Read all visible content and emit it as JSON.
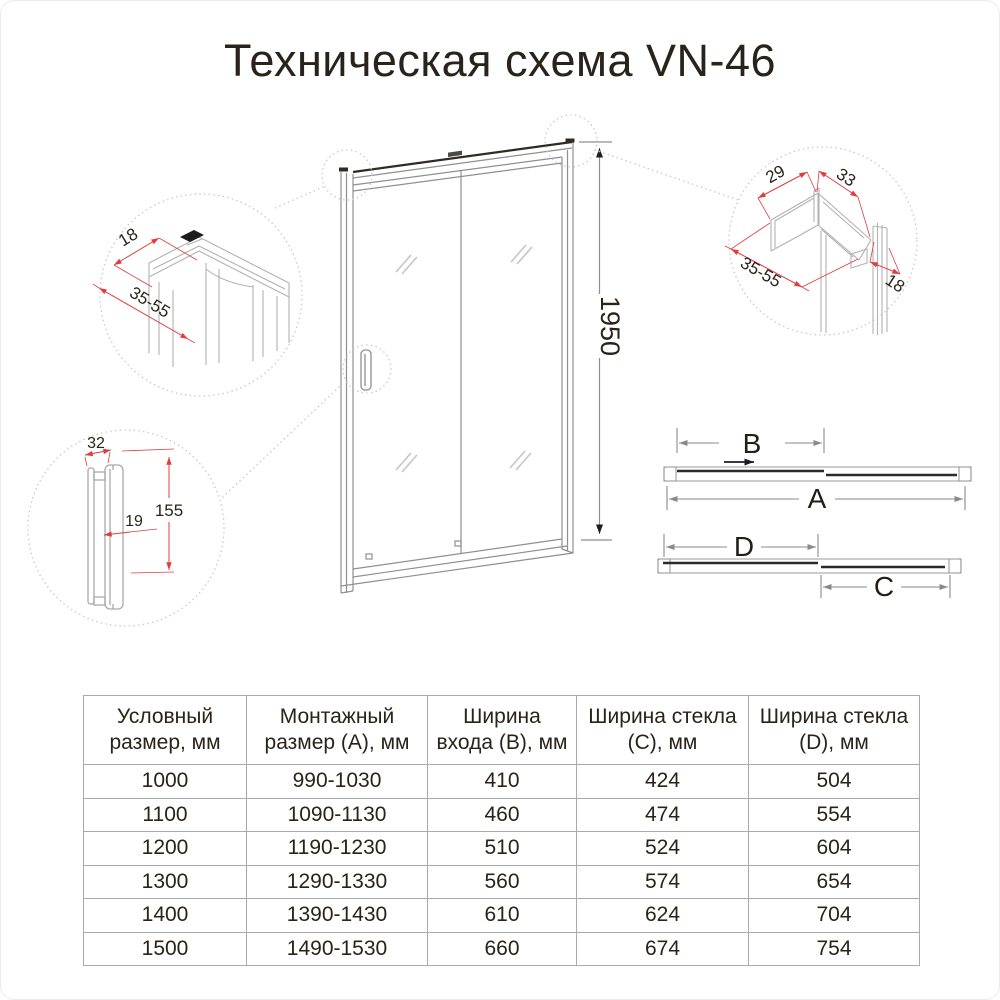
{
  "title": "Техническая схема VN-46",
  "diagram": {
    "door_height_mm": "1950",
    "top_left_detail": {
      "profile_depth": "18",
      "adjustment_range": "35-55"
    },
    "top_right_detail": {
      "inner_width": "29",
      "outer_width": "33",
      "adjustment_range": "35-55",
      "profile_depth": "18"
    },
    "handle_detail": {
      "width": "32",
      "height": "155",
      "depth": "19"
    },
    "top_view": {
      "dim_a": "A",
      "dim_b": "B",
      "dim_c": "C",
      "dim_d": "D"
    }
  },
  "table": {
    "headers": [
      "Условный размер, мм",
      "Монтажный размер (А), мм",
      "Ширина входа (В), мм",
      "Ширина стекла (С), мм",
      "Ширина стекла (D), мм"
    ],
    "rows": [
      [
        "1000",
        "990-1030",
        "410",
        "424",
        "504"
      ],
      [
        "1100",
        "1090-1130",
        "460",
        "474",
        "554"
      ],
      [
        "1200",
        "1190-1230",
        "510",
        "524",
        "604"
      ],
      [
        "1300",
        "1290-1330",
        "560",
        "574",
        "654"
      ],
      [
        "1400",
        "1390-1430",
        "610",
        "624",
        "704"
      ],
      [
        "1500",
        "1490-1530",
        "660",
        "674",
        "754"
      ]
    ]
  }
}
